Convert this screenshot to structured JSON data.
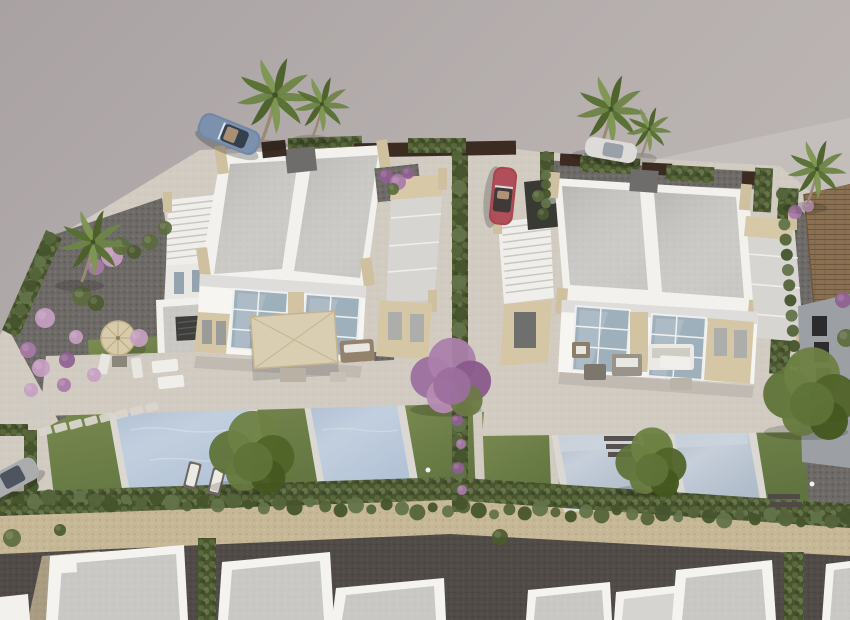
{
  "scene": {
    "title": "Aerial 3D architectural render of a residential development",
    "description": "Bird's-eye CGI visualization of two white modern duplex villas with flat grey roofs, roof terraces, private pools and landscaped gardens, bordered by hedges, a sandstone wall, a dark gravel lane and a row of neighbouring white houses at the bottom",
    "view": "oblique aerial, daytime",
    "inventory": {
      "duplex_villas": 2,
      "private_pools": 4,
      "roof_terraces": 2,
      "staircases": 2,
      "palm_trees": 6,
      "ornamental_trees": 4,
      "flowering_bushes": "pink and purple clusters in gravel garden",
      "parasols": [
        "square beige parasol on left villa terrace",
        "round straw parasol in left garden"
      ],
      "bottom_row_houses": 7,
      "neighbour_house_tiled_roof": 1
    },
    "vehicles": [
      {
        "name": "blue convertible sports car",
        "location": "road top-left"
      },
      {
        "name": "white car",
        "location": "road top-centre behind palms"
      },
      {
        "name": "red convertible",
        "location": "driveway between villas"
      },
      {
        "name": "silver car",
        "location": "driveway bottom-left"
      }
    ]
  },
  "palette": {
    "ground_grey": "#b3acab",
    "road_light": "#c3bdbb",
    "villa_white": "#f4f3f0",
    "roof_grey": "#c9c8c5",
    "stone_beige": "#cfc0a0",
    "window_glass": "#9fb0bd",
    "pool_water": "#b7c6da",
    "pool_water_right": "#bac4d1",
    "lawn_green": "#71834a",
    "hedge_green": "#4c5a33",
    "gravel_dark": "#6e6a67",
    "lane_dark": "#504b46",
    "sand_wall": "#c6b797",
    "flower_pink": "#c79fc2",
    "flower_purple": "#8f5f91",
    "car_blue": "#7288a6",
    "car_red": "#a84750",
    "tiled_roof_brown": "#8a7052"
  }
}
